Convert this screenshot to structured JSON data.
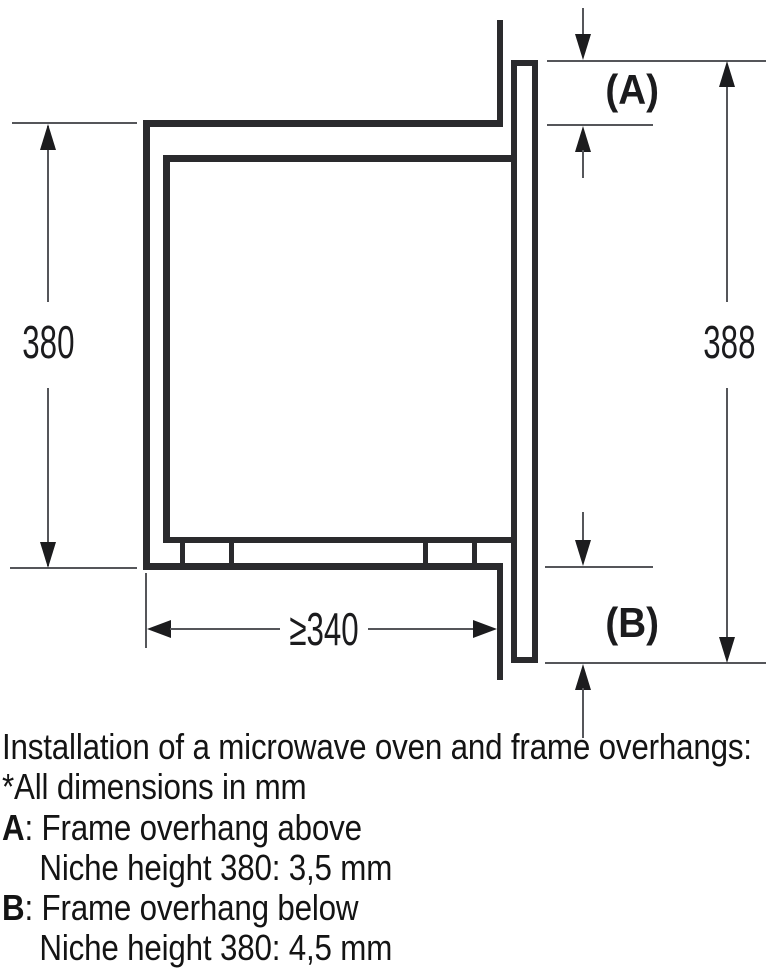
{
  "diagram": {
    "niche_height_label": "380",
    "frame_height_label": "388",
    "niche_depth_label": "≥340",
    "overhang_above_label": "(A)",
    "overhang_below_label": "(B)"
  },
  "caption": {
    "title": "Installation of a microwave oven and frame overhangs:",
    "note": "*All dimensions in mm",
    "items": [
      {
        "key": "A",
        "text": ": Frame overhang above",
        "detail": "Niche height 380: 3,5 mm"
      },
      {
        "key": "B",
        "text": ": Frame overhang below",
        "detail": "Niche height 380: 4,5 mm"
      }
    ]
  }
}
